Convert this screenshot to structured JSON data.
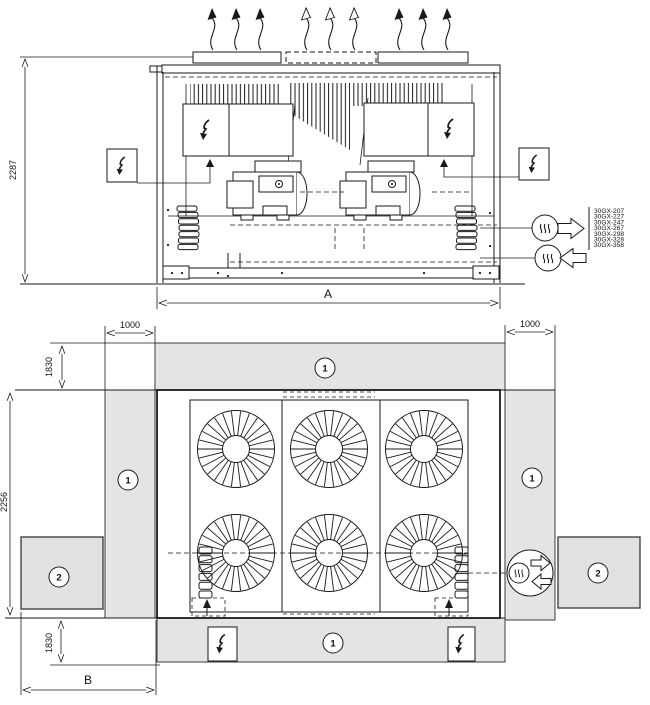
{
  "colors": {
    "line": "#1a1a1a",
    "clearance_fill": "#e4e4e4",
    "background": "#ffffff"
  },
  "icons": {
    "electrical_hazard": "lightning-bolt",
    "water_connection_out": "heat-waves-arrow-right",
    "water_connection_in": "heat-waves-arrow-left",
    "air_discharge": "wavy-arrow-up",
    "fan": "radial-fan"
  },
  "elevation": {
    "dims": {
      "height": "2287",
      "width": "A"
    },
    "models": [
      "30GX-207",
      "30GX-227",
      "30GX-247",
      "30GX-267",
      "30GX-298",
      "30GX-328",
      "30GX-358"
    ]
  },
  "plan": {
    "dims": {
      "clearance_left": "1000",
      "clearance_right": "1000",
      "clearance_top": "1830",
      "unit_depth": "2256",
      "clearance_bottom": "1830",
      "width": "B"
    },
    "zone_labels": {
      "air": "1",
      "service": "2"
    }
  }
}
